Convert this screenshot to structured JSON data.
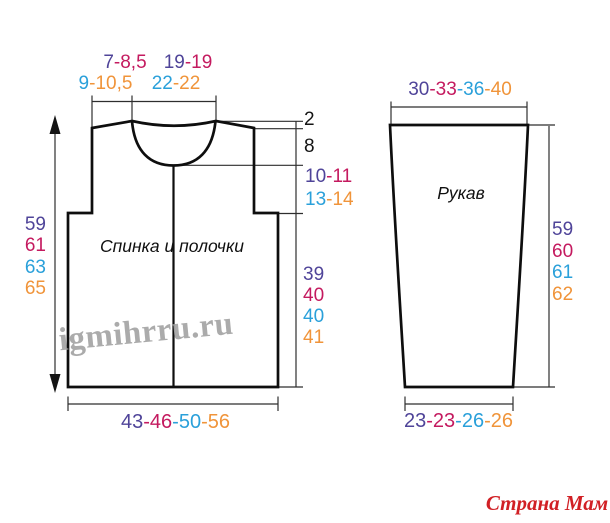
{
  "palette": {
    "size1": "#4f4499",
    "size2": "#c41a5f",
    "size3": "#2aa0da",
    "size4": "#f0943a",
    "ink": "#141414",
    "wm": "#a2a2a2",
    "brand": "#d12025"
  },
  "watermark": {
    "text": "igmihrru.ru"
  },
  "site_logo": {
    "text": "Страна Мам"
  },
  "back_piece": {
    "label": "Спинка и полочки",
    "dims": {
      "shoulder_row1": [
        "7",
        "-8,5"
      ],
      "shoulder_row2": [
        "9",
        "-10,5"
      ],
      "neck_row1": [
        "19",
        "-19"
      ],
      "neck_row2": [
        "22",
        "-22"
      ],
      "shoulder_drop": "2",
      "neck_depth": "8",
      "yoke_row1": [
        "10",
        "-11"
      ],
      "yoke_row2": [
        "13",
        "-14"
      ],
      "total_length": [
        "59",
        "61",
        "63",
        "65"
      ],
      "side_length": [
        "39",
        "40",
        "40",
        "41"
      ],
      "hem_width": [
        "43",
        "-46",
        "-50",
        "-56"
      ]
    }
  },
  "sleeve_piece": {
    "label": "Рукав",
    "dims": {
      "top_width": [
        "30",
        "-33",
        "-36",
        "-40"
      ],
      "length": [
        "59",
        "60",
        "61",
        "62"
      ],
      "cuff_width": [
        "23",
        "-23",
        "-26",
        "-26"
      ]
    }
  }
}
